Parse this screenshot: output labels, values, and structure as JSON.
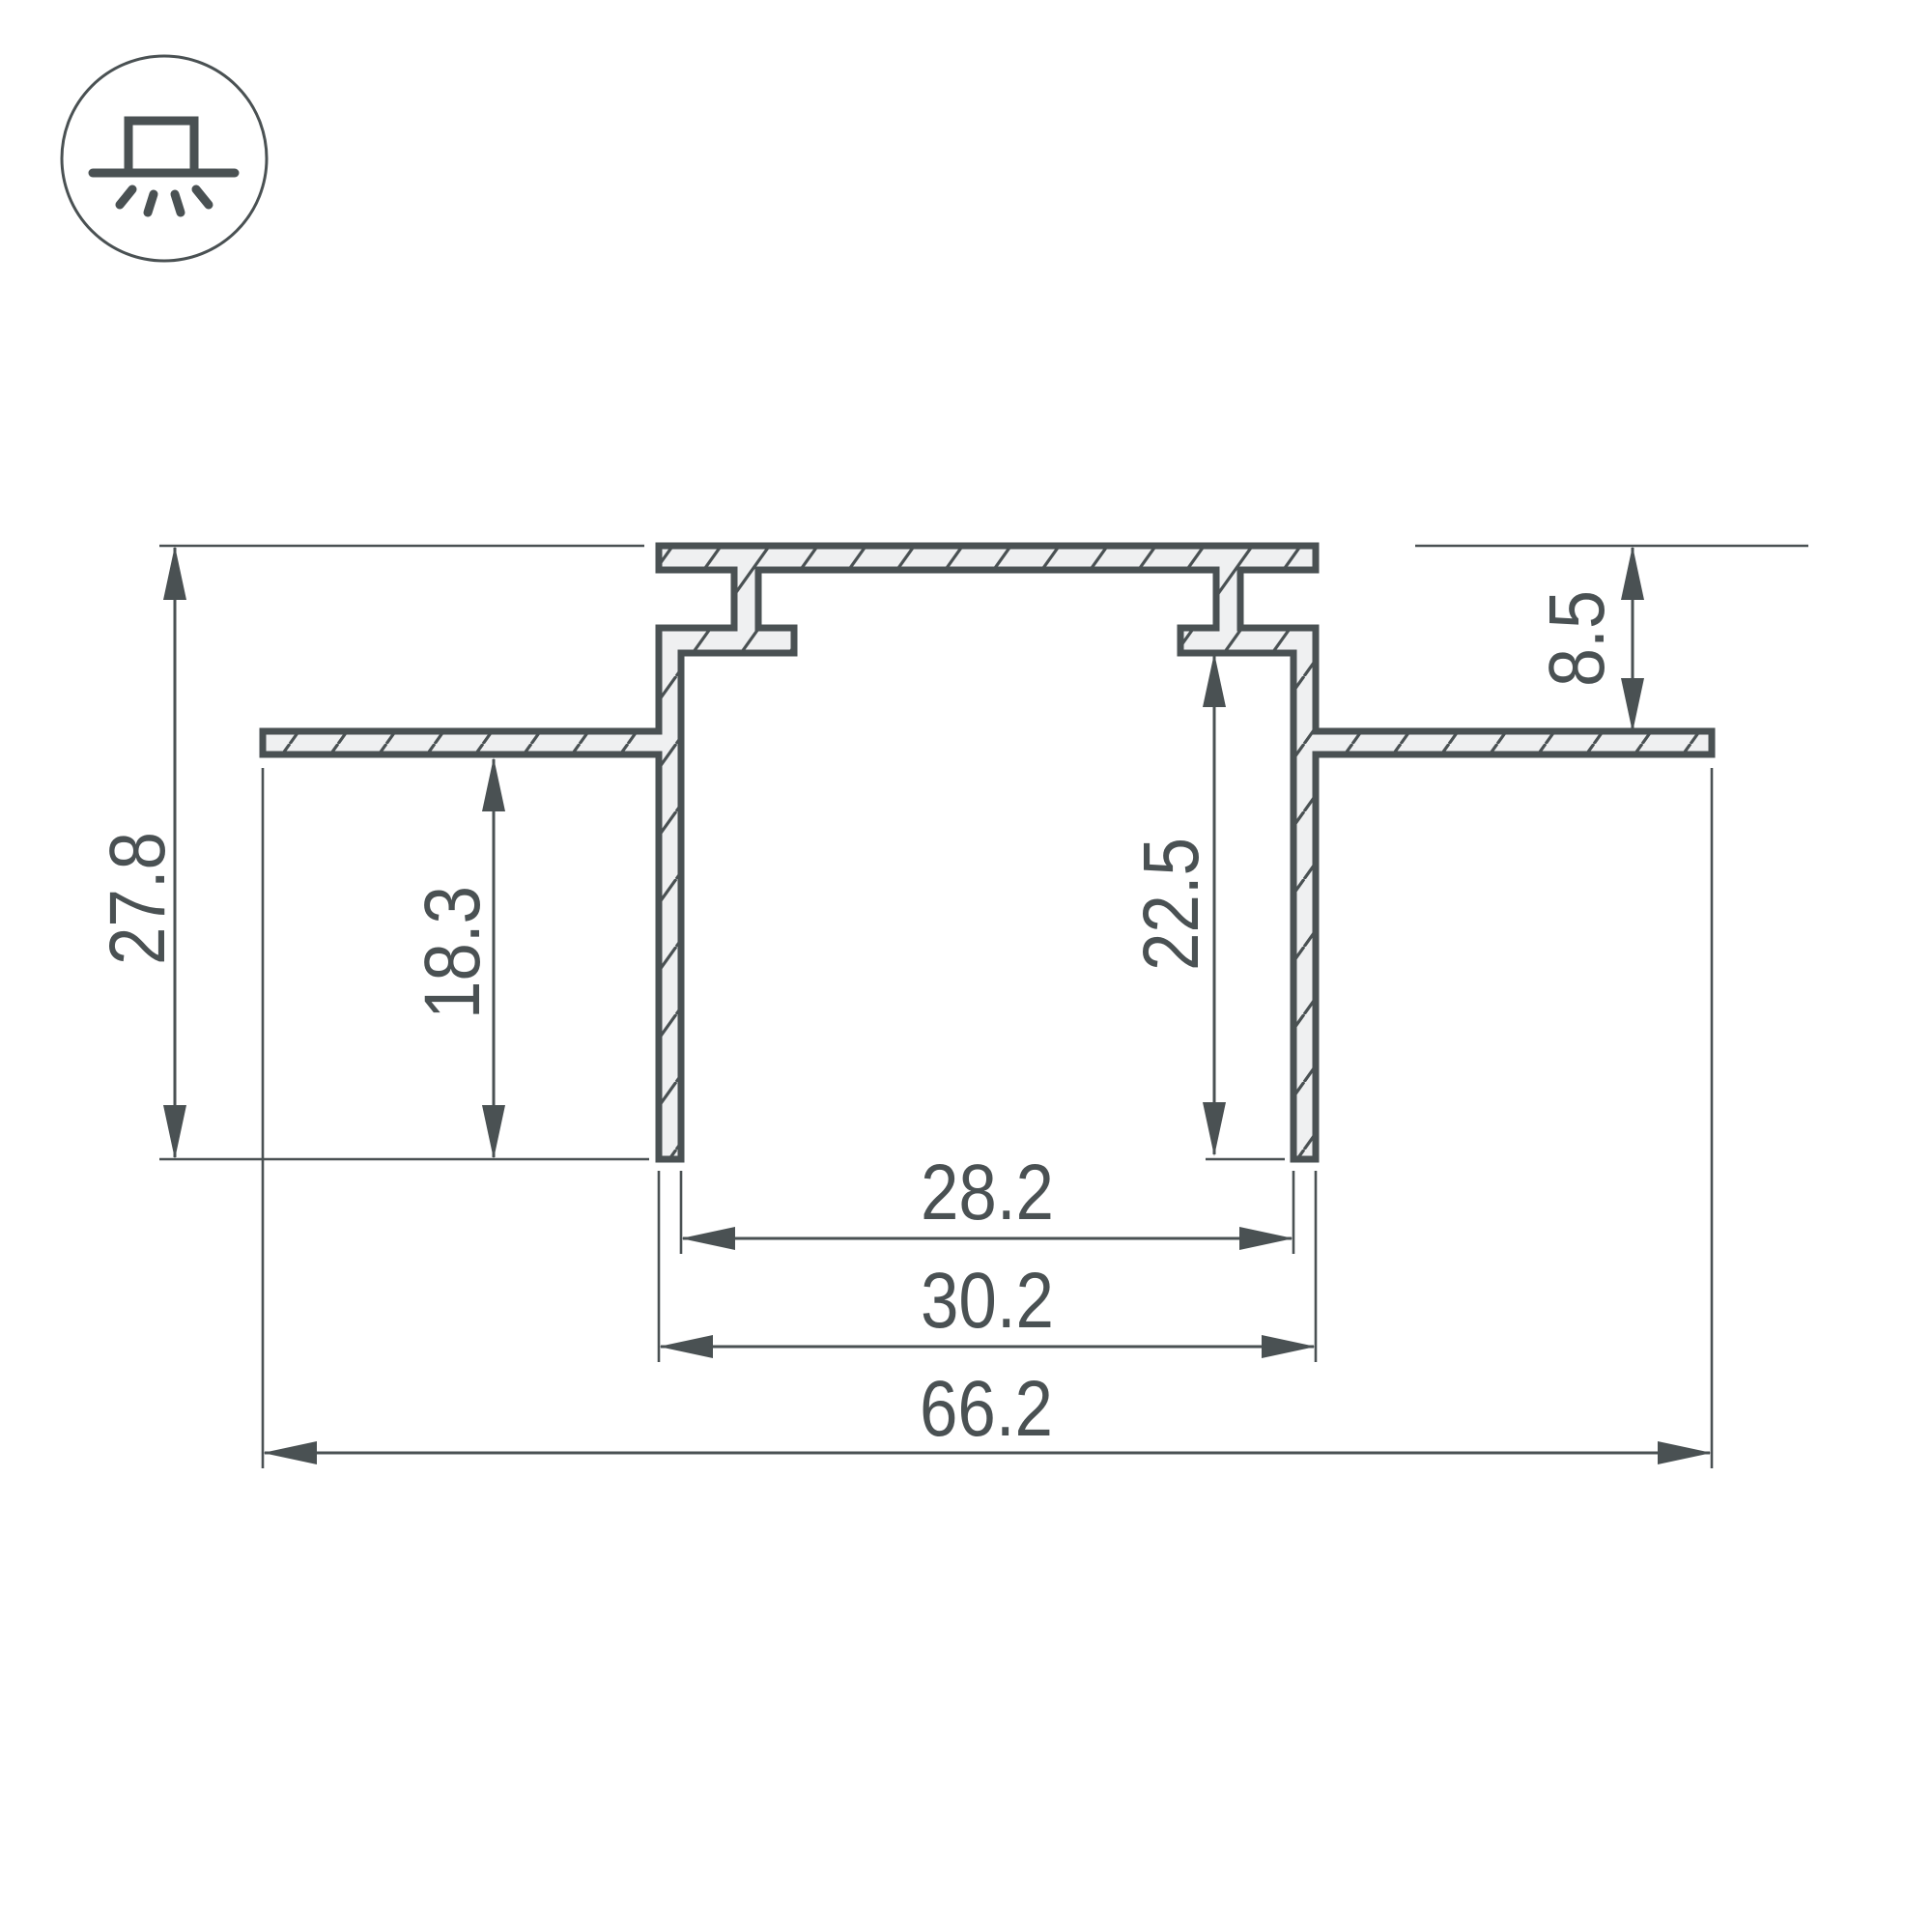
{
  "icon": {
    "name": "recessed-mount-light-icon"
  },
  "colors": {
    "line": "#4A5153",
    "profile_fill": "#EFF0F1",
    "background": "#FFFFFF"
  },
  "dimensions": {
    "overall_height": {
      "label": "27.8",
      "value": 27.8,
      "orientation": "vertical"
    },
    "wing_to_bottom": {
      "label": "18.3",
      "value": 18.3,
      "orientation": "vertical"
    },
    "cavity_depth": {
      "label": "22.5",
      "value": 22.5,
      "orientation": "vertical"
    },
    "top_to_wing": {
      "label": "8.5",
      "value": 8.5,
      "orientation": "vertical"
    },
    "inner_width": {
      "label": "28.2",
      "value": 28.2,
      "orientation": "horizontal"
    },
    "outer_width": {
      "label": "30.2",
      "value": 30.2,
      "orientation": "horizontal"
    },
    "overall_width": {
      "label": "66.2",
      "value": 66.2,
      "orientation": "horizontal"
    }
  }
}
